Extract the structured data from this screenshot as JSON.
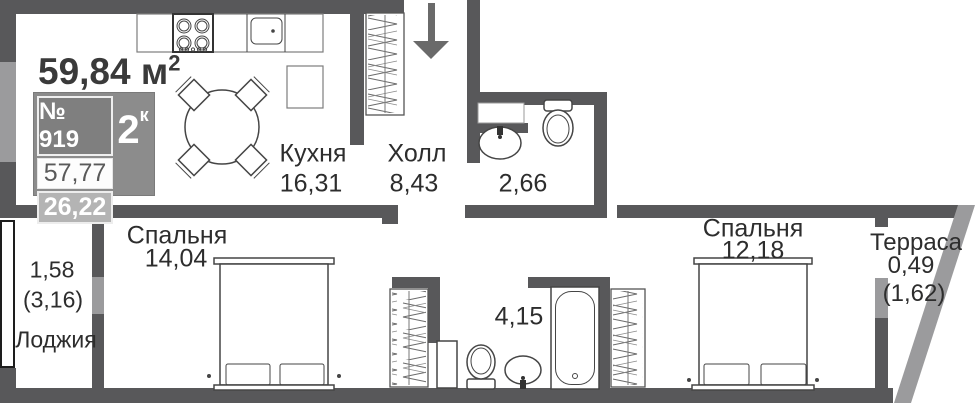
{
  "plan": {
    "total_area": {
      "value": "59,84 м",
      "sup": "2"
    },
    "unit_badge": {
      "number": "№ 919",
      "type_value": "2",
      "type_sup": "к",
      "area_main": "57,77",
      "area_secondary": "26,22"
    },
    "rooms": {
      "kitchen": {
        "name": "Кухня",
        "area": "16,31"
      },
      "hall": {
        "name": "Холл",
        "area": "8,43"
      },
      "bathroom_small": {
        "area": "2,66"
      },
      "bedroom_1": {
        "name": "Спальня",
        "area": "14,04"
      },
      "bathroom_large": {
        "area": "4,15"
      },
      "bedroom_2": {
        "name": "Спальня",
        "area": "12,18"
      },
      "terrace": {
        "name": "Терраса",
        "area": "0,49",
        "area_full": "(1,62)"
      },
      "loggia": {
        "name": "Лоджия",
        "area": "1,58",
        "area_full": "(3,16)"
      }
    },
    "colors": {
      "wall": "#58585a",
      "window_glass": "#9b9b9d",
      "fixture_line": "#454545",
      "text": "#2d2d2d",
      "badge_bg": "#8c8c8c",
      "badge_number_bg": "#7f7f7f",
      "badge_secondary_bg": "#b4b4b4"
    }
  }
}
